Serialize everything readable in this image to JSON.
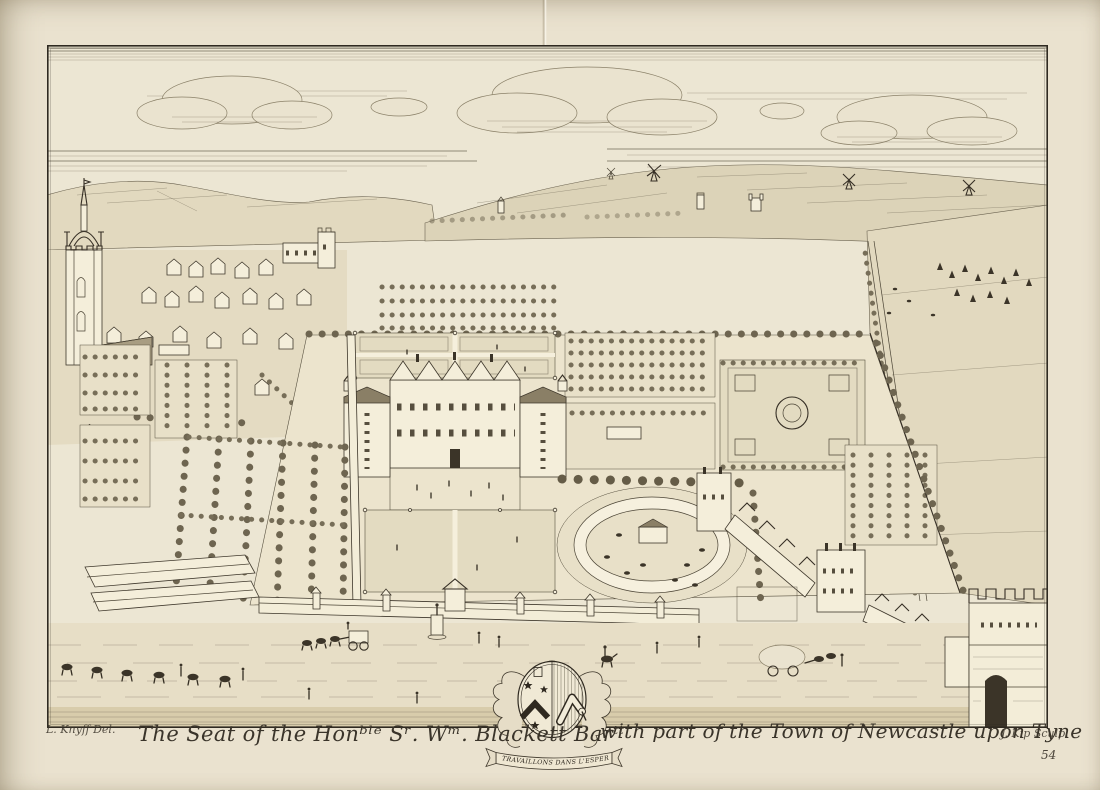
{
  "page": {
    "paper_color": "#eae2cf",
    "ink_color": "#3a342a",
    "plate_number": "54"
  },
  "plate": {
    "title_left": "The Seat of the Honᵇˡᵉ Sʳ. Wᵐ. Blackett Barᵗᵗ",
    "title_right": "with part of the Town of Newcastle upon Tyne",
    "credit_left": "L. Knyff Del.",
    "credit_right": "J. Kip Sculp.",
    "motto": "NOUS TRAVAILLONS DANS L'ESPERANCE"
  },
  "scene": {
    "clouds": "engraved cloud bank",
    "windmills": "windmills on the moor horizon",
    "church": "church tower with crown spire",
    "town": "rooftops of Newcastle",
    "mansion": "the Blackett mansion with gabled front",
    "parterre": "formal parterre lawns with statues",
    "orchard": "walled orchard plots",
    "avenue": "tree-lined avenues",
    "green": "bowling green garden",
    "ring": "circular ride with centre shed and grazing animals",
    "fields": "open fields with hay stooks",
    "service": "service houses and yards",
    "road": "foreground road with pack train, coach and travellers",
    "wall_tower": "battlemented town-wall tower and gate",
    "arms": "Blackett coat of arms cartouche"
  }
}
